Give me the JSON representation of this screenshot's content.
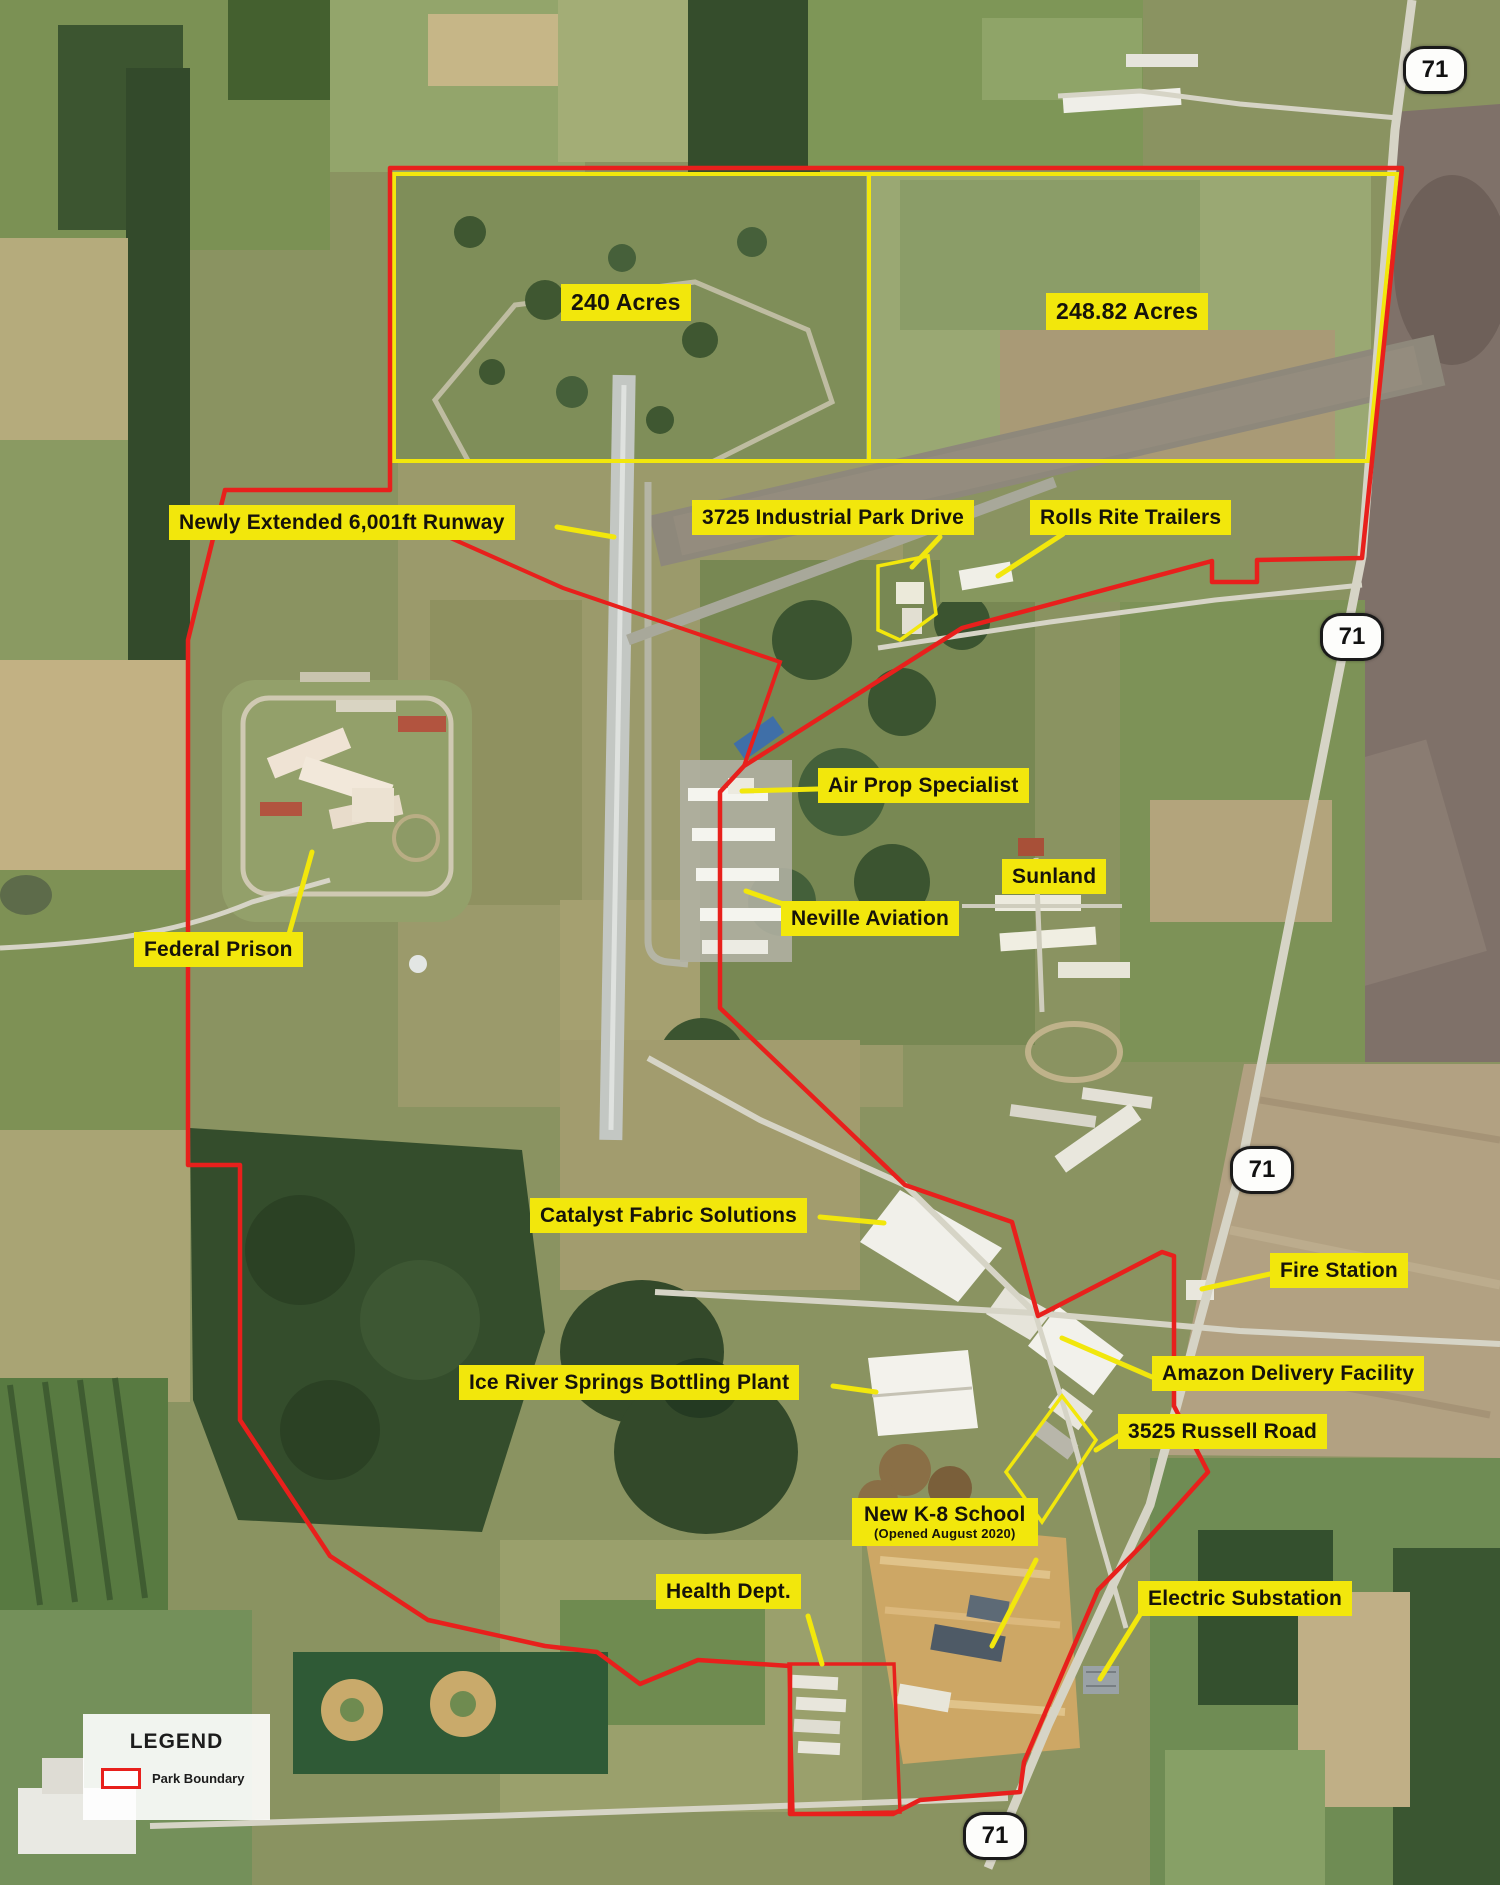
{
  "map": {
    "labels": {
      "acres240": "240 Acres",
      "acres248": "248.82 Acres",
      "runway": "Newly Extended 6,001ft Runway",
      "industrial_drive": "3725 Industrial Park Drive",
      "rolls_rite": "Rolls Rite Trailers",
      "air_prop": "Air Prop Specialist",
      "sunland": "Sunland",
      "neville": "Neville Aviation",
      "federal_prison": "Federal Prison",
      "catalyst": "Catalyst Fabric Solutions",
      "fire_station": "Fire Station",
      "ice_river": "Ice River Springs Bottling Plant",
      "amazon": "Amazon Delivery Facility",
      "russell": "3525 Russell Road",
      "school_line1": "New K-8 School",
      "school_line2": "(Opened August 2020)",
      "health": "Health Dept.",
      "substation": "Electric Substation"
    },
    "shields": {
      "route": "71"
    },
    "legend": {
      "title": "LEGEND",
      "boundary": "Park Boundary"
    },
    "colors": {
      "label_background": "#f2e70c",
      "park_boundary": "#e8201c",
      "acreage_outline": "#f2e70c"
    }
  }
}
